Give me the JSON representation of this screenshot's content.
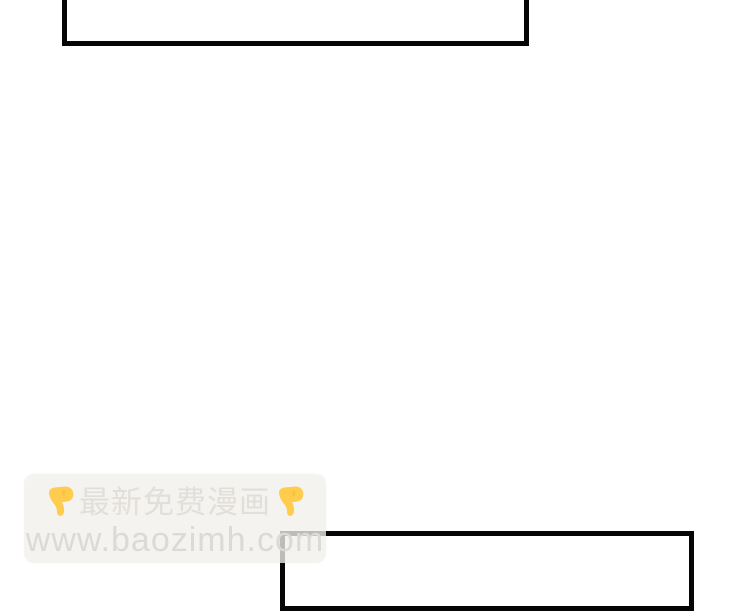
{
  "page": {
    "background_color": "#ffffff",
    "description_colors": {
      "panel_border": "#060606",
      "watermark_box": "#f1efec",
      "watermark_text": "#e2dfdb",
      "watermark_url_text": "#dcdad6",
      "emoji_yellow": "#ffcc4d"
    }
  },
  "watermark": {
    "line1": "最新免费漫画",
    "line2": "www.baozimh.com",
    "left_icon": "backhand-index-pointing-down",
    "right_icon": "backhand-index-pointing-down"
  }
}
